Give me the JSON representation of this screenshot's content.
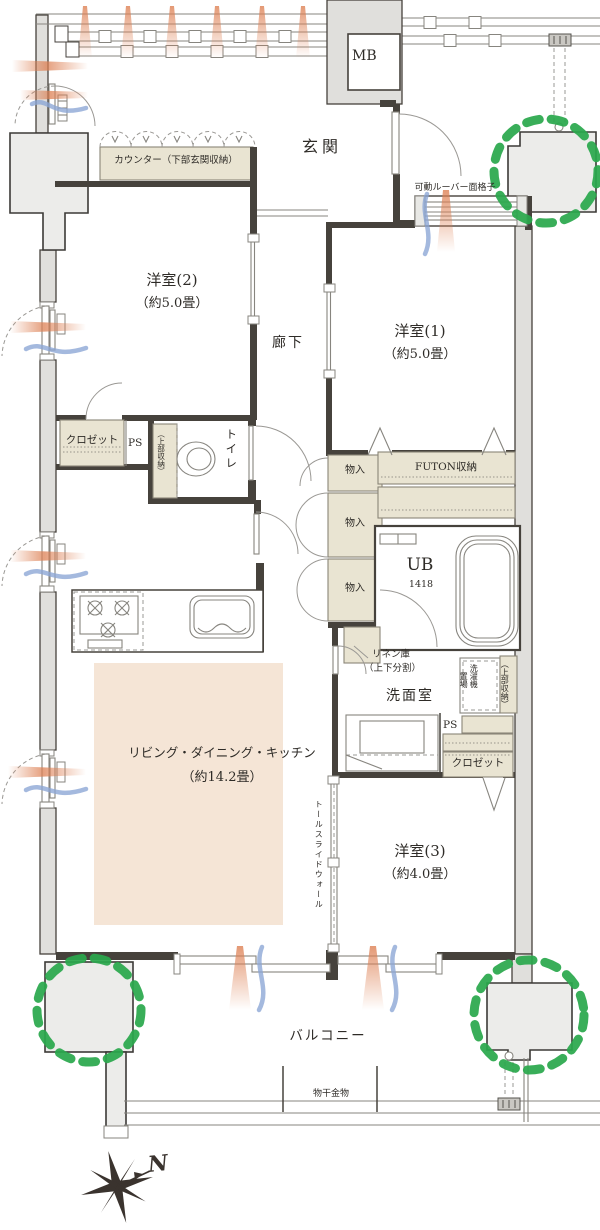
{
  "rooms": {
    "genkan": {
      "label": "玄関"
    },
    "western2": {
      "label": "洋室(2)",
      "size": "（約5.0畳）"
    },
    "western1": {
      "label": "洋室(1)",
      "size": "（約5.0畳）"
    },
    "western3": {
      "label": "洋室(3)",
      "size": "（約4.0畳）"
    },
    "ldk": {
      "label": "リビング・ダイニング・キッチン",
      "size": "（約14.2畳）"
    },
    "hallway": {
      "label": "廊下"
    },
    "toilet": {
      "label": "トイレ",
      "note": "（上部収納）"
    },
    "washroom": {
      "label": "洗面室"
    },
    "bath": {
      "label": "UB",
      "size": "1418"
    },
    "balcony": {
      "label": "バルコニー"
    }
  },
  "storage": {
    "entry_counter": {
      "label": "カウンター（下部玄関収納）"
    },
    "closet_w2": {
      "label": "クロゼット"
    },
    "closet_w3": {
      "label": "クロゼット"
    },
    "futon": {
      "label": "FUTON収納"
    },
    "monoiri": [
      {
        "label": "物入"
      },
      {
        "label": "物入"
      },
      {
        "label": "物入"
      }
    ],
    "linen": {
      "label": "リネン庫",
      "note": "（上下分割）"
    },
    "laundry": {
      "label_machine": "洗濯機",
      "label_place": "置場",
      "upper": "（上部収納）"
    },
    "mb": {
      "label": "MB"
    },
    "ps_north": {
      "label": "PS"
    },
    "ps_south": {
      "label": "PS"
    }
  },
  "annotations": {
    "louver": "可動ルーバー面格子",
    "tall_slide_wall": "トールスライドウォール",
    "laundry_hardware": "物干金物",
    "compass": "N"
  },
  "colors": {
    "wall": "#46423c",
    "storage_fill": "#e9e4d2",
    "ldk_floor": "#f5e5d6",
    "pillar_fill": "#ececea",
    "outer_band": "#e0dfdc",
    "green_marker": "#2aa84c",
    "airflow_warm": "#dd7f52",
    "airflow_cool": "#8aa5d5"
  }
}
